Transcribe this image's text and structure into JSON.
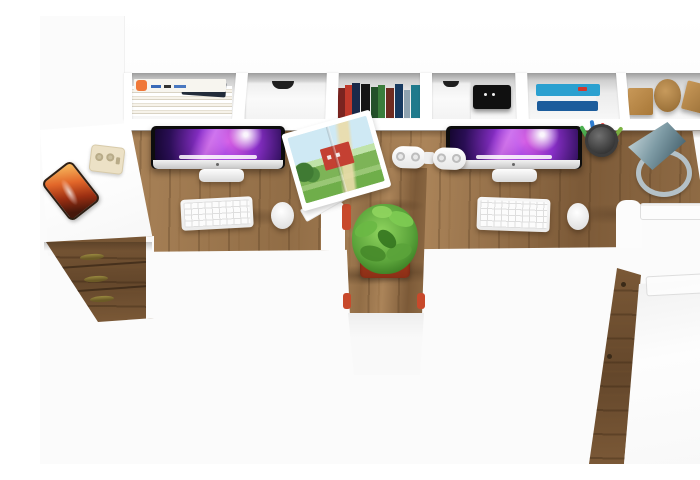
{
  "meta": {
    "title": "Top-down product photo: two-person L-shaped computer desk with hutch",
    "description": "Bird's-eye view of a white and oak double workstation: wall hutch with cubbies holding magazines, books and wooden blocks; oak desktop with two iMac computers, keyboards and mice; open magazine, power strip, pen cup, desk lamp, potted plant, smartphone, drawer pedestal and side cabinet."
  },
  "colors": {
    "bg": "#fbfbfb",
    "wood-light": "#ab8459",
    "wood-mid": "#916d46",
    "wood-dark": "#7c5a38",
    "wood-drawer": "#7b5937",
    "wood-drawer-dark": "#64472b",
    "bezel": "#0d0d0d",
    "chin-hi": "#f2f2f2",
    "chin-lo": "#c6c6c6",
    "wall-magenta": "#e060e0",
    "wall-purple": "#8a2fc9",
    "wall-deep": "#2a0e55",
    "plant-hi": "#8fd45e",
    "plant-mid": "#5aa33a",
    "plant-dark": "#35761f",
    "pot-hi": "#cf4e2d",
    "pot-lo": "#8c2f16",
    "lamp-hi": "#c6d6da",
    "lamp-mid": "#7d9aa4",
    "lamp-dark": "#44606c",
    "ring": "#b4c1c7",
    "device-black": "#101010",
    "phone-hi": "#f6b45a",
    "phone-mid": "#e2672a",
    "phone-dark": "#45170b",
    "cream": "#ece1c6",
    "brass": "#6b5a26",
    "folder-navy": "#232c3a",
    "barn-red": "#c44032",
    "shadow": "rgba(50,32,16,0.38)"
  },
  "scene": {
    "objects": [
      "hutch shelf unit with six cubbies",
      "magazine stack",
      "white cubby drawer",
      "standing books row",
      "black storage device",
      "blue book stack",
      "wooden toy blocks",
      "oak desktop",
      "left iMac",
      "right iMac",
      "white keyboard x2",
      "white mouse x2",
      "open farm magazine",
      "white power strip",
      "mesh pen cup with pens",
      "grey cone desk lamp",
      "green potted plant in red pot",
      "white return desk",
      "smartphone with orange case",
      "cream socket adapter",
      "oak drawer pedestal with brass handles",
      "oak-door side cabinet with white top"
    ]
  },
  "decor": {
    "book_spines": [
      {
        "name": "book-spine",
        "color": "#7a2420",
        "w": 7,
        "h": 30
      },
      {
        "name": "book-spine",
        "color": "#c0392b",
        "w": 7,
        "h": 33
      },
      {
        "name": "book-spine",
        "color": "#1b2a4a",
        "w": 8,
        "h": 35
      },
      {
        "name": "book-spine",
        "color": "#141414",
        "w": 9,
        "h": 34,
        "ml": 1
      },
      {
        "name": "book-spine",
        "color": "#24512a",
        "w": 7,
        "h": 31,
        "ml": 1
      },
      {
        "name": "book-spine",
        "color": "#3b7d3c",
        "w": 7,
        "h": 33
      },
      {
        "name": "book-spine",
        "color": "#6e2b20",
        "w": 8,
        "h": 30,
        "ml": 1
      },
      {
        "name": "book-spine",
        "color": "#173a60",
        "w": 8,
        "h": 34,
        "ml": 1
      },
      {
        "name": "book-spine",
        "color": "#8fa3b0",
        "w": 6,
        "h": 28,
        "ml": 1
      },
      {
        "name": "book-spine",
        "color": "#1f7a8c",
        "w": 9,
        "h": 33,
        "ml": 1
      }
    ],
    "pens": [
      {
        "name": "pen-green",
        "color": "#4caf50",
        "w": 4,
        "h": 18,
        "rot": -30
      },
      {
        "name": "pen-blue",
        "color": "#2e7dd1",
        "w": 4,
        "h": 22,
        "rot": -10,
        "ml": 2
      },
      {
        "name": "pen-red",
        "color": "#e53935",
        "w": 4,
        "h": 19,
        "rot": 6,
        "ml": 2
      },
      {
        "name": "pen-yellow",
        "color": "#fbc02d",
        "w": 4,
        "h": 15,
        "rot": 22,
        "ml": 2
      },
      {
        "name": "pen-lightgreen",
        "color": "#7cb342",
        "w": 4,
        "h": 18,
        "rot": 38,
        "ml": 1
      },
      {
        "name": "pen-grey",
        "color": "#616161",
        "w": 3,
        "h": 14,
        "rot": -46,
        "ml": 2
      }
    ],
    "magazine_dashes": [
      {
        "name": "magazine-title-dash",
        "color": "#3a6ab8",
        "w": 10,
        "h": 3
      },
      {
        "name": "magazine-title-dash",
        "color": "#333333",
        "w": 7,
        "h": 3,
        "ml": 3
      },
      {
        "name": "magazine-title-dash",
        "color": "#4a78c0",
        "w": 12,
        "h": 3,
        "ml": 3
      }
    ],
    "blue_book_layers": [
      {
        "name": "blue-book-top",
        "color": "#2aa0d0",
        "w": 64,
        "h": 12,
        "r": 2
      },
      {
        "name": "blue-book-pages",
        "color": "#eef2f5",
        "w": 58,
        "h": 5,
        "ml": 2
      },
      {
        "name": "blue-book-bottom",
        "color": "#1c5c9c",
        "w": 61,
        "h": 10,
        "ml": 1,
        "r": 2
      }
    ]
  }
}
